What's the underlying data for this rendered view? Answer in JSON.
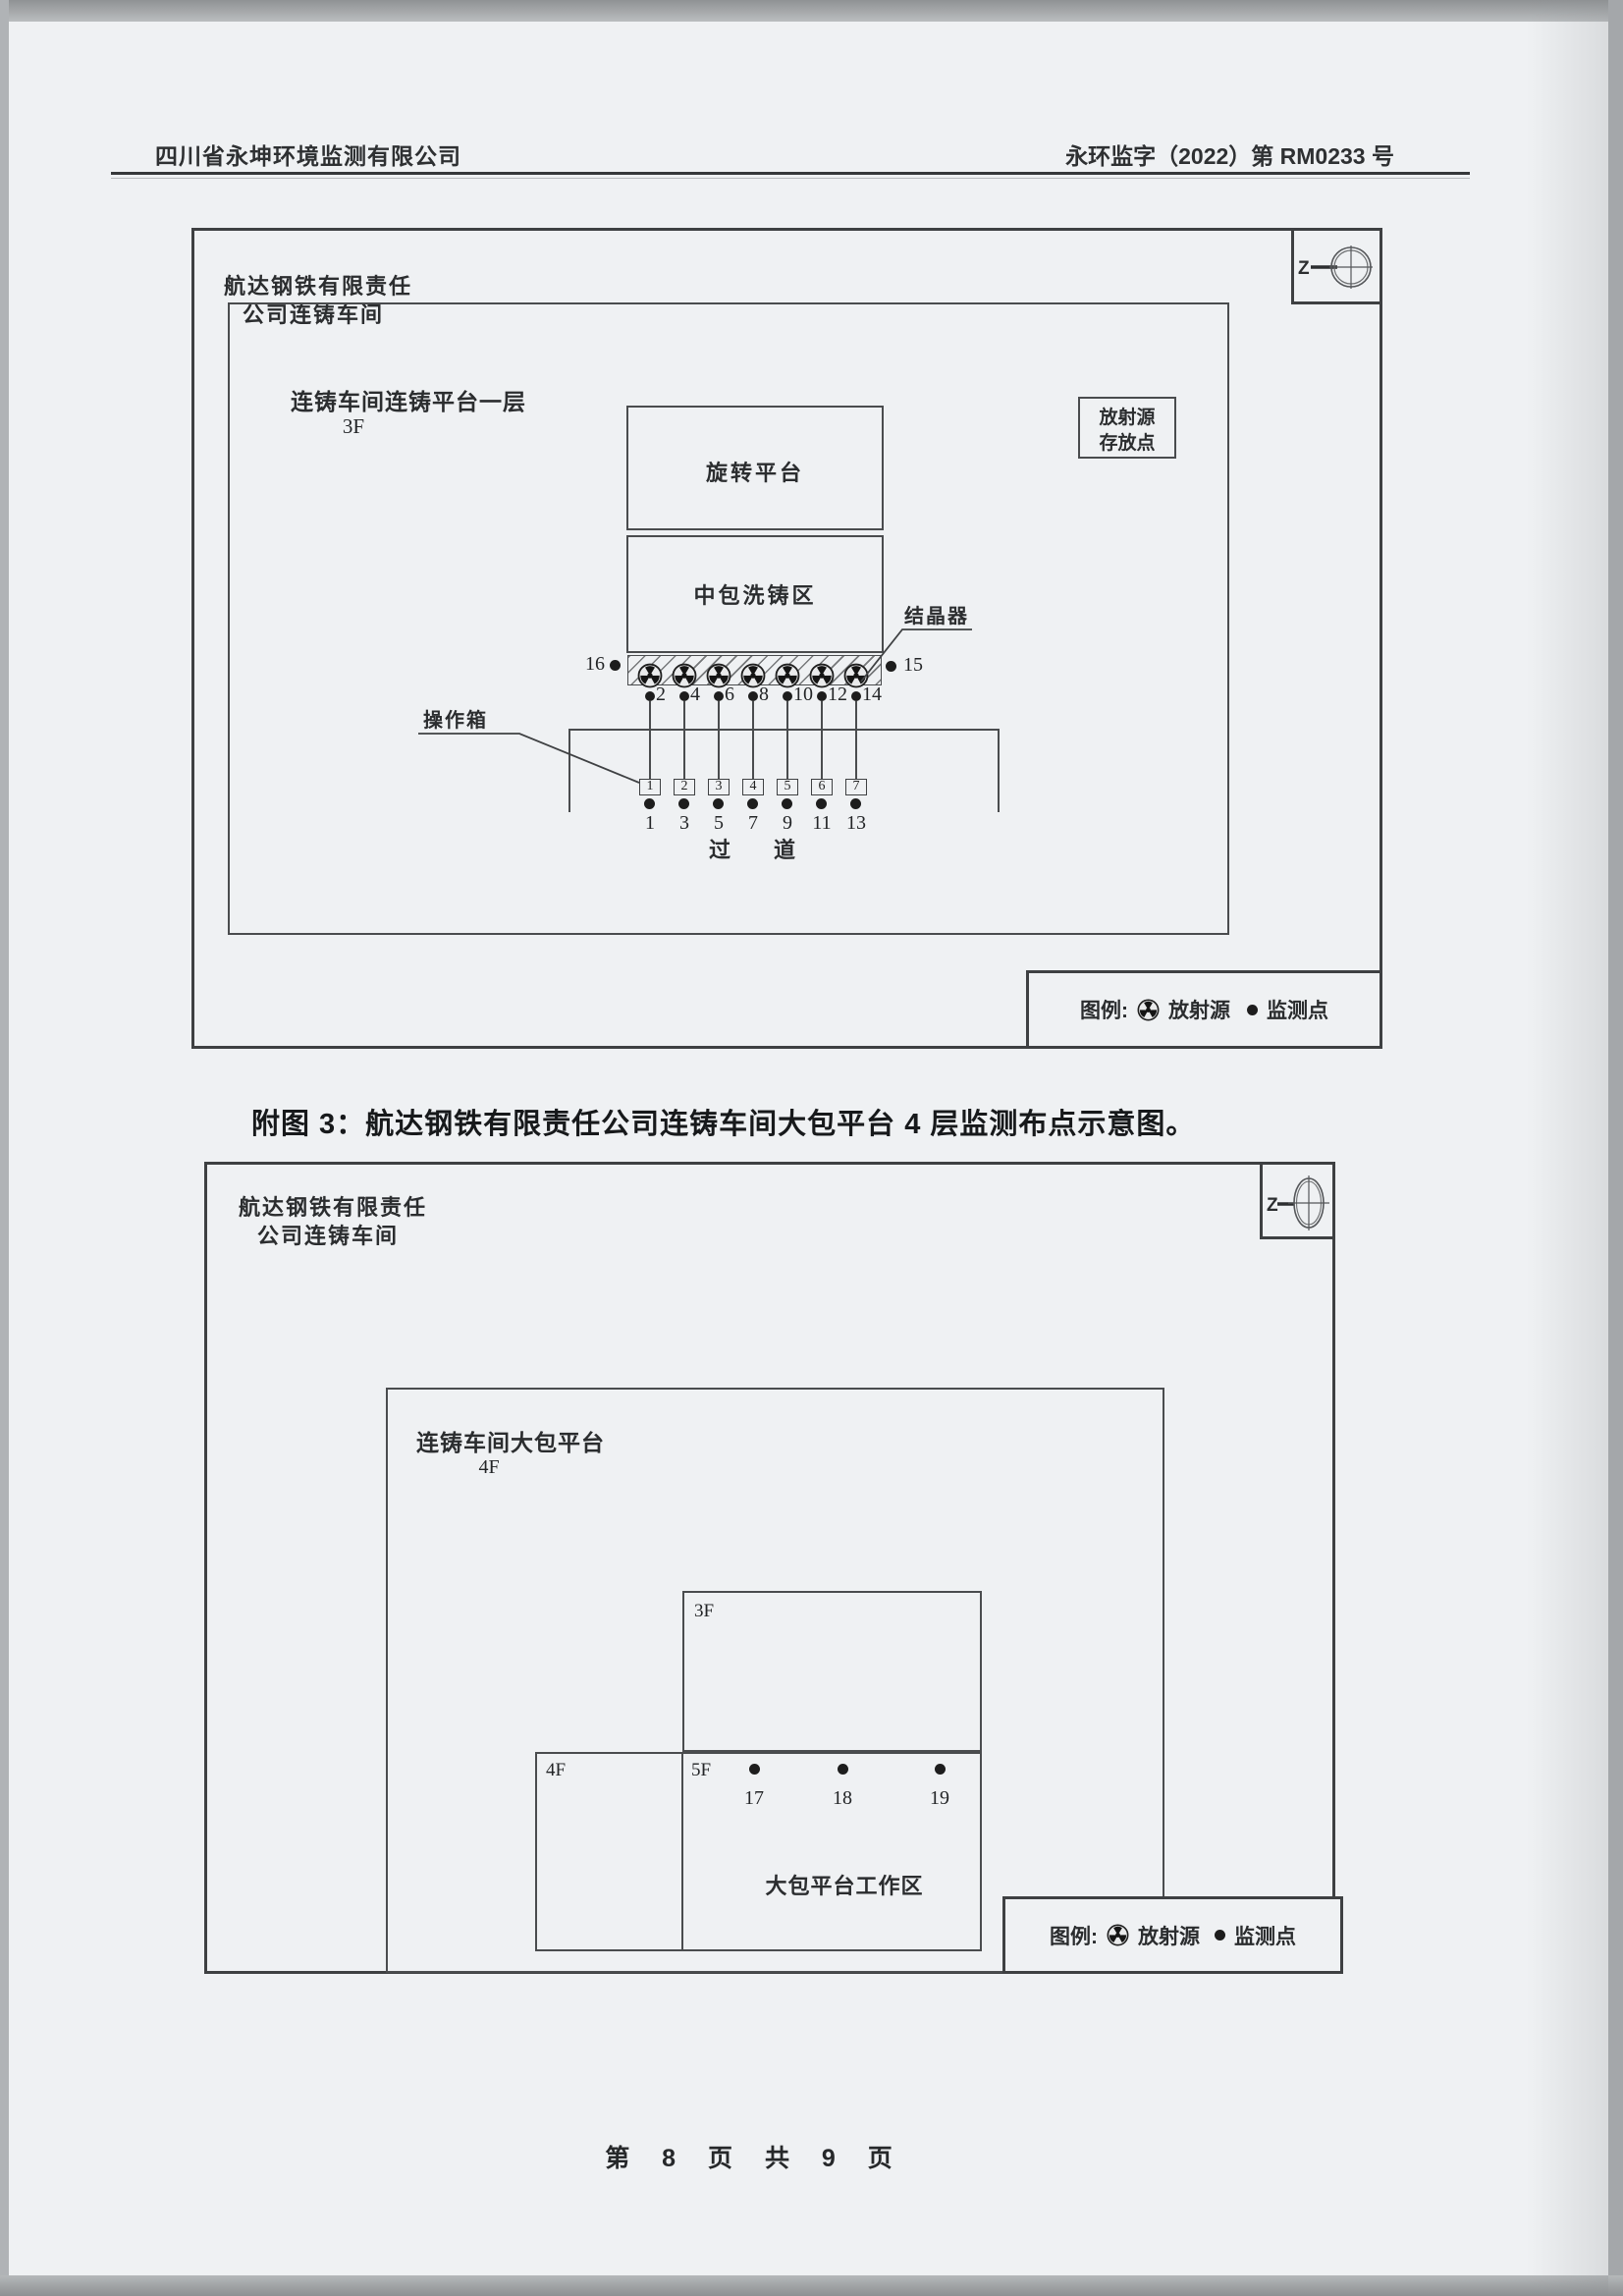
{
  "header": {
    "company": "四川省永坤环境监测有限公司",
    "doc_no": "永环监字（2022）第 RM0233 号"
  },
  "legend": {
    "label": "图例:",
    "source_label": "放射源",
    "monitor_label": "监测点"
  },
  "diagram1": {
    "workshop_line1": "航达钢铁有限责任",
    "workshop_line2": "公司连铸车间",
    "area_label": "连铸车间连铸平台一层",
    "floor_label": "3F",
    "compass_label": "Z",
    "storage_line1": "放射源",
    "storage_line2": "存放点",
    "rotate_platform": "旋转平台",
    "tundish_area": "中包洗铸区",
    "crystallizer_label": "结晶器",
    "operator_box_label": "操作箱",
    "aisle_label": "过　　道",
    "left_point": "16",
    "right_point": "15",
    "source_points": [
      "2",
      "4",
      "6",
      "8",
      "10",
      "12",
      "14"
    ],
    "operation_boxes": [
      "1",
      "2",
      "3",
      "4",
      "5",
      "6",
      "7"
    ],
    "aisle_points": [
      "1",
      "3",
      "5",
      "7",
      "9",
      "11",
      "13"
    ]
  },
  "caption": "附图 3：航达钢铁有限责任公司连铸车间大包平台 4 层监测布点示意图。",
  "diagram2": {
    "workshop_line1": "航达钢铁有限责任",
    "workshop_line2": "公司连铸车间",
    "area_label": "连铸车间大包平台",
    "floor_label": "4F",
    "compass_label": "Z",
    "box_3f": "3F",
    "box_4f": "4F",
    "box_5f": "5F",
    "work_area": "大包平台工作区",
    "points": [
      "17",
      "18",
      "19"
    ]
  },
  "footer": "第 8 页 共 9 页"
}
